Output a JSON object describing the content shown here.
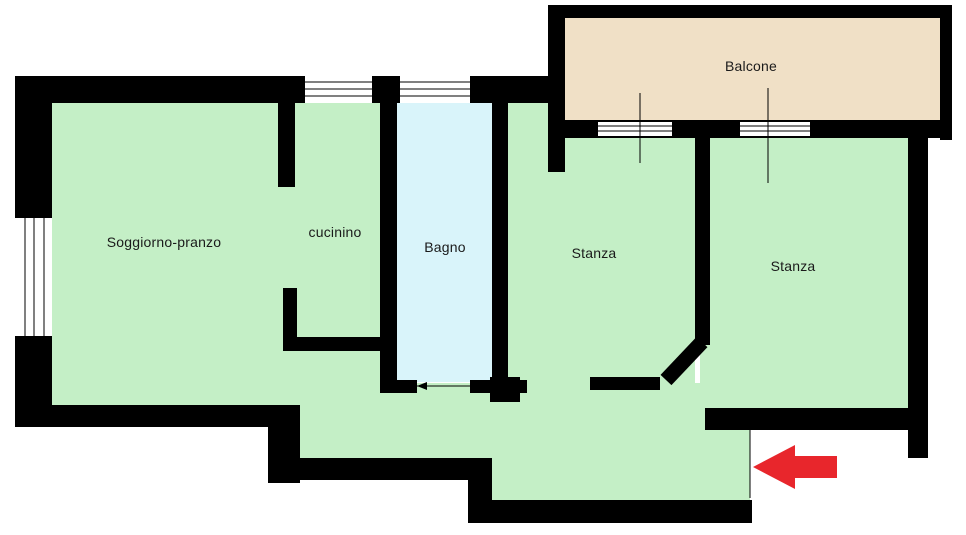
{
  "title": "Apartment floor plan",
  "colors": {
    "wall": "#000000",
    "room_green": "#c4efc6",
    "bath_blue": "#d9f4fa",
    "balcony_beige": "#f0e0c6",
    "arrow_red": "#e8262c",
    "background": "#ffffff",
    "label_text": "#1a1a1a"
  },
  "floor_plan": {
    "rooms": [
      {
        "id": "soggiorno-pranzo",
        "label": "Soggiorno-pranzo"
      },
      {
        "id": "cucinino",
        "label": "cucinino"
      },
      {
        "id": "bagno",
        "label": "Bagno"
      },
      {
        "id": "stanza-1",
        "label": "Stanza"
      },
      {
        "id": "stanza-2",
        "label": "Stanza"
      },
      {
        "id": "balcone",
        "label": "Balcone"
      }
    ],
    "entrance_arrow": {
      "direction": "left",
      "color": "#e8262c"
    }
  }
}
